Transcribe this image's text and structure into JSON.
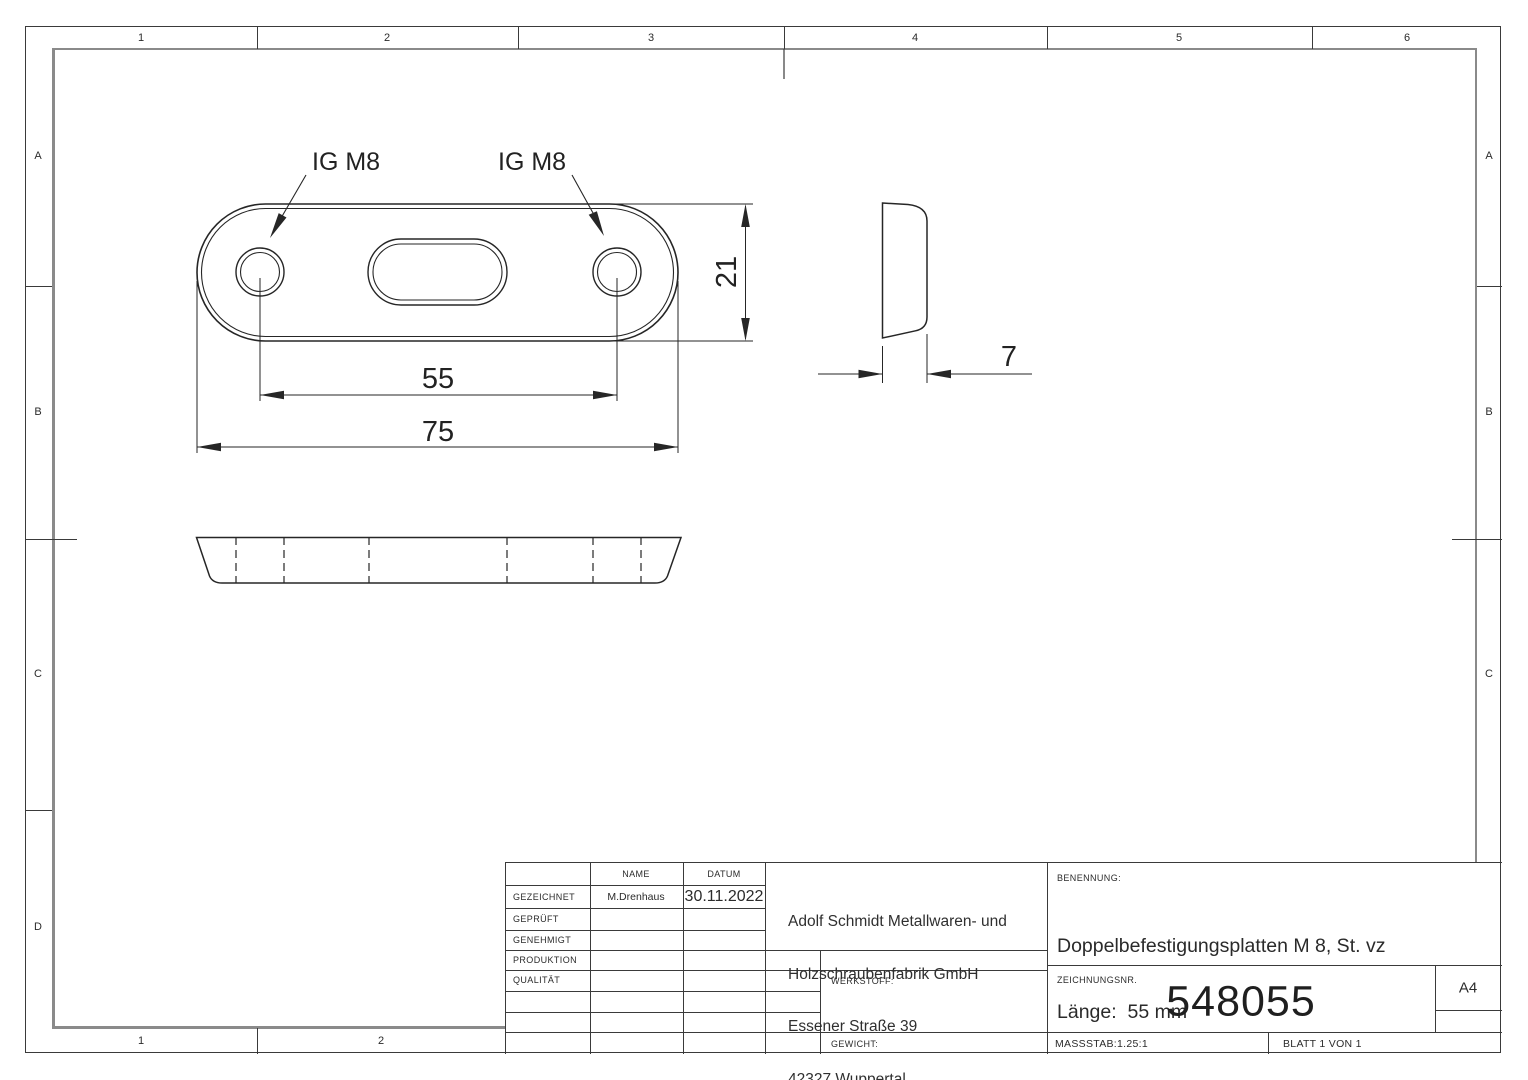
{
  "border": {
    "top_labels": [
      "1",
      "2",
      "3",
      "4",
      "5",
      "6"
    ],
    "bottom_labels": [
      "1",
      "2"
    ],
    "left_labels": [
      "A",
      "B",
      "C",
      "D"
    ],
    "right_labels": [
      "A",
      "B",
      "C"
    ]
  },
  "views": {
    "leader_label_1": "IG M8",
    "leader_label_2": "IG M8",
    "dim_hole_spacing": "55",
    "dim_total_width": "75",
    "dim_plate_height": "21",
    "dim_thickness": "7"
  },
  "title_block": {
    "col_name": "NAME",
    "col_date": "DATUM",
    "rows": [
      {
        "label": "GEZEICHNET",
        "name": "M.Drenhaus",
        "date": "30.11.2022"
      },
      {
        "label": "GEPRÜFT",
        "name": "",
        "date": ""
      },
      {
        "label": "GENEHMIGT",
        "name": "",
        "date": ""
      },
      {
        "label": "PRODUKTION",
        "name": "",
        "date": ""
      },
      {
        "label": "QUALITÄT",
        "name": "",
        "date": ""
      }
    ],
    "company_lines": [
      "Adolf Schmidt Metallwaren- und",
      "Holzschraubenfabrik GmbH",
      "Essener Straße 39",
      "42327 Wuppertal"
    ],
    "werkstoff_label": "WERKSTOFF:",
    "gewicht_label": "GEWICHT:",
    "benennung_label": "BENENNUNG:",
    "part_title_line1": "Doppelbefestigungsplatten M 8, St. vz",
    "part_title_line2": "Länge:  55 mm",
    "zeichnungsnr_label": "ZEICHNUNGSNR.",
    "drawing_number": "548055",
    "paper_format": "A4",
    "scale_label": "MASSSTAB:1.25:1",
    "sheet_label": "BLATT 1 VON 1"
  }
}
